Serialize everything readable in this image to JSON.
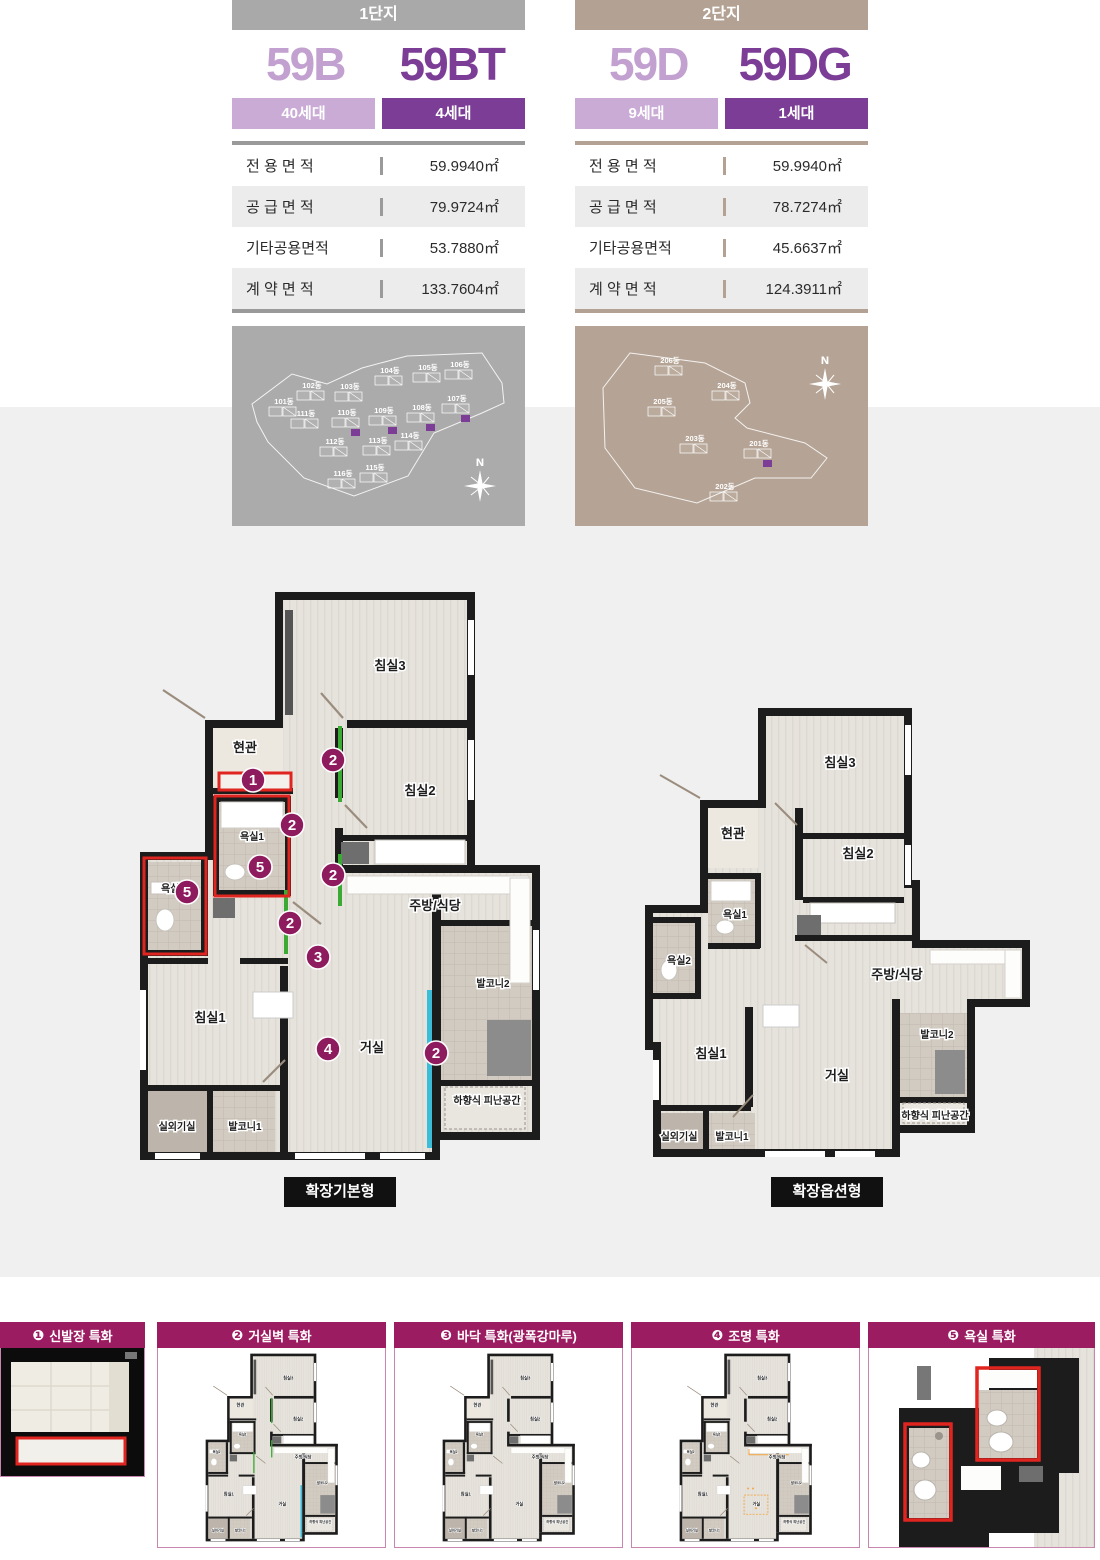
{
  "colors": {
    "purple_dark": "#7c3d96",
    "purple_light": "#c2a0d0",
    "badge_light": "#c9abd6",
    "magenta_header": "#9c1c62",
    "badge_circle": "#8e1b5e",
    "red_outline": "#e0241f",
    "accent_green": "#3aaa35",
    "accent_cyan": "#3bbcd9",
    "accent_orange": "#f3a33c",
    "bar_gray": "#a9a9a9",
    "bar_tan": "#b3a294",
    "bg_mid": "#f0f0f0"
  },
  "complexes": [
    {
      "name": "1단지",
      "types": [
        {
          "code": "59B",
          "units": "40세대"
        },
        {
          "code": "59BT",
          "units": "4세대"
        }
      ],
      "area_table": [
        {
          "label": "전 용 면 적",
          "value": "59.9940㎡"
        },
        {
          "label": "공 급 면 적",
          "value": "79.9724㎡"
        },
        {
          "label": "기타공용면적",
          "value": "53.7880㎡"
        },
        {
          "label": "계 약 면 적",
          "value": "133.7604㎡"
        }
      ],
      "sitemap": {
        "compass": "N",
        "buildings": [
          {
            "name": "101동",
            "x": 52,
            "y": 78,
            "hl": false
          },
          {
            "name": "102동",
            "x": 80,
            "y": 62,
            "hl": false
          },
          {
            "name": "103동",
            "x": 118,
            "y": 63,
            "hl": false
          },
          {
            "name": "104동",
            "x": 158,
            "y": 47,
            "hl": false
          },
          {
            "name": "105동",
            "x": 196,
            "y": 44,
            "hl": false
          },
          {
            "name": "106동",
            "x": 228,
            "y": 41,
            "hl": false
          },
          {
            "name": "107동",
            "x": 225,
            "y": 75,
            "hl": true
          },
          {
            "name": "108동",
            "x": 190,
            "y": 84,
            "hl": true
          },
          {
            "name": "109동",
            "x": 152,
            "y": 87,
            "hl": true
          },
          {
            "name": "110동",
            "x": 115,
            "y": 89,
            "hl": true
          },
          {
            "name": "111동",
            "x": 74,
            "y": 90,
            "hl": false
          },
          {
            "name": "112동",
            "x": 103,
            "y": 118,
            "hl": false
          },
          {
            "name": "113동",
            "x": 146,
            "y": 117,
            "hl": false
          },
          {
            "name": "114동",
            "x": 178,
            "y": 112,
            "hl": false
          },
          {
            "name": "115동",
            "x": 143,
            "y": 144,
            "hl": false
          },
          {
            "name": "116동",
            "x": 111,
            "y": 150,
            "hl": false
          }
        ]
      }
    },
    {
      "name": "2단지",
      "types": [
        {
          "code": "59D",
          "units": "9세대"
        },
        {
          "code": "59DG",
          "units": "1세대"
        }
      ],
      "area_table": [
        {
          "label": "전 용 면 적",
          "value": "59.9940㎡"
        },
        {
          "label": "공 급 면 적",
          "value": "78.7274㎡"
        },
        {
          "label": "기타공용면적",
          "value": "45.6637㎡"
        },
        {
          "label": "계 약 면 적",
          "value": "124.3911㎡"
        }
      ],
      "sitemap": {
        "compass": "N",
        "buildings": [
          {
            "name": "206동",
            "x": 95,
            "y": 37,
            "hl": false
          },
          {
            "name": "204동",
            "x": 152,
            "y": 62,
            "hl": false
          },
          {
            "name": "205동",
            "x": 88,
            "y": 78,
            "hl": false
          },
          {
            "name": "203동",
            "x": 120,
            "y": 115,
            "hl": false
          },
          {
            "name": "201동",
            "x": 184,
            "y": 120,
            "hl": true
          },
          {
            "name": "202동",
            "x": 150,
            "y": 163,
            "hl": false
          }
        ]
      }
    }
  ],
  "floorplans": {
    "basic": {
      "variant_label": "확장기본형",
      "rooms": [
        {
          "name": "침실3",
          "x": 255,
          "y": 80
        },
        {
          "name": "현관",
          "x": 110,
          "y": 162
        },
        {
          "name": "침실2",
          "x": 285,
          "y": 205
        },
        {
          "name": "욕실1",
          "x": 117,
          "y": 250,
          "small": true
        },
        {
          "name": "욕실2",
          "x": 38,
          "y": 302,
          "small": true
        },
        {
          "name": "주방/식당",
          "x": 300,
          "y": 320
        },
        {
          "name": "발코니2",
          "x": 358,
          "y": 397,
          "small": true
        },
        {
          "name": "침실1",
          "x": 75,
          "y": 432
        },
        {
          "name": "거실",
          "x": 237,
          "y": 462
        },
        {
          "name": "하향식 피난공간",
          "x": 352,
          "y": 514,
          "small": true
        },
        {
          "name": "실외기실",
          "x": 42,
          "y": 540,
          "small": true
        },
        {
          "name": "발코니1",
          "x": 110,
          "y": 540,
          "small": true
        }
      ],
      "badges": [
        {
          "n": "1",
          "x": 118,
          "y": 190
        },
        {
          "n": "2",
          "x": 198,
          "y": 170
        },
        {
          "n": "2",
          "x": 157,
          "y": 235
        },
        {
          "n": "2",
          "x": 198,
          "y": 285
        },
        {
          "n": "2",
          "x": 155,
          "y": 333
        },
        {
          "n": "3",
          "x": 183,
          "y": 367
        },
        {
          "n": "4",
          "x": 193,
          "y": 459
        },
        {
          "n": "5",
          "x": 125,
          "y": 277
        },
        {
          "n": "5",
          "x": 52,
          "y": 302
        },
        {
          "n": "2",
          "x": 301,
          "y": 463
        }
      ]
    },
    "option": {
      "variant_label": "확장옵션형",
      "rooms": [
        {
          "name": "침실3",
          "x": 195,
          "y": 62
        },
        {
          "name": "현관",
          "x": 88,
          "y": 133
        },
        {
          "name": "침실2",
          "x": 213,
          "y": 153
        },
        {
          "name": "욕실1",
          "x": 90,
          "y": 213,
          "small": true
        },
        {
          "name": "욕실2",
          "x": 34,
          "y": 259,
          "small": true
        },
        {
          "name": "주방/식당",
          "x": 252,
          "y": 274
        },
        {
          "name": "발코니2",
          "x": 292,
          "y": 333,
          "small": true
        },
        {
          "name": "침실1",
          "x": 66,
          "y": 353
        },
        {
          "name": "거실",
          "x": 192,
          "y": 375
        },
        {
          "name": "하향식 피난공간",
          "x": 290,
          "y": 414,
          "small": true
        },
        {
          "name": "실외기실",
          "x": 34,
          "y": 435,
          "small": true
        },
        {
          "name": "발코니1",
          "x": 87,
          "y": 435,
          "small": true
        }
      ]
    }
  },
  "features": [
    {
      "num": "❶",
      "title": "신발장 특화"
    },
    {
      "num": "❷",
      "title": "거실벽 특화"
    },
    {
      "num": "❸",
      "title": "바닥 특화(광폭강마루)"
    },
    {
      "num": "❹",
      "title": "조명 특화"
    },
    {
      "num": "❺",
      "title": "욕실 특화"
    }
  ]
}
